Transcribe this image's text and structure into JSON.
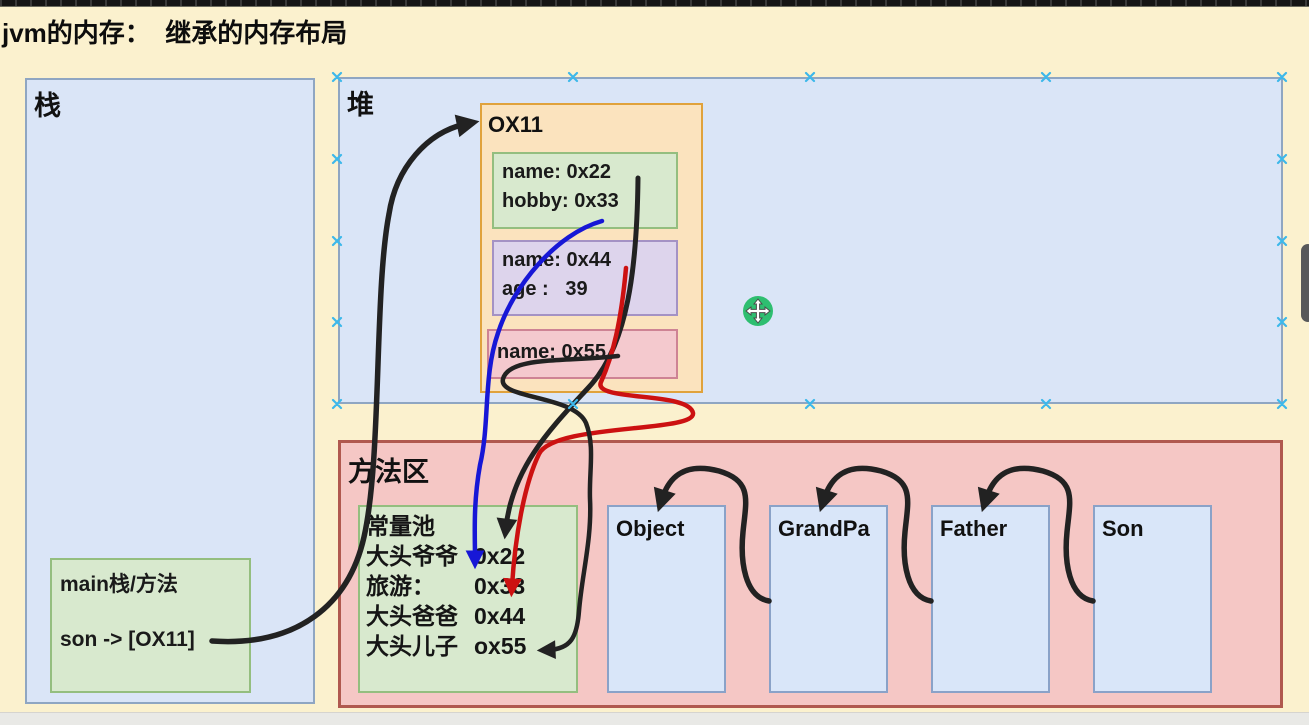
{
  "title": "jvm的内存：  继承的内存布局",
  "stack": {
    "label": "栈",
    "frame": {
      "line1": "main栈/方法",
      "line2": "son -> [OX11]"
    }
  },
  "heap": {
    "label": "堆",
    "object": {
      "title": "OX11",
      "record1": {
        "line1": "name: 0x22",
        "line2": "hobby: 0x33"
      },
      "record2": {
        "line1": "name: 0x44",
        "line2": "age :   39"
      },
      "record3": {
        "line1": "name: 0x55"
      }
    }
  },
  "method_area": {
    "label": "方法区",
    "constant_pool": {
      "title": "常量池",
      "entries": [
        {
          "name": "大头爷爷",
          "value": "0x22"
        },
        {
          "name": "旅游：",
          "value": "0x33"
        },
        {
          "name": "大头爸爸",
          "value": "0x44"
        },
        {
          "name": "大头儿子",
          "value": "ox55"
        }
      ]
    },
    "classes": [
      {
        "label": "Object"
      },
      {
        "label": "GrandPa"
      },
      {
        "label": "Father"
      },
      {
        "label": "Son"
      }
    ]
  },
  "colors": {
    "canvas_bg": "#FBF1CE",
    "region_blue_fill": "#DAE5F7",
    "region_blue_border": "#8FA6C2",
    "object_fill": "#FBE3BE",
    "object_border": "#E0A23C",
    "green_fill": "#D8E9CE",
    "green_border": "#94BE7F",
    "purple_fill": "#DDD4EC",
    "purple_border": "#A492C4",
    "pink_fill": "#F4C9CE",
    "pink_border": "#CE8394",
    "method_fill": "#F5C7C5",
    "method_border": "#B0594F",
    "arrow_black": "#222222",
    "arrow_blue": "#1717D6",
    "arrow_red": "#CC1111",
    "selection_handle": "#3DB8EA",
    "cursor_green": "#2EBE70",
    "scrollbar_thumb": "#57585A"
  }
}
